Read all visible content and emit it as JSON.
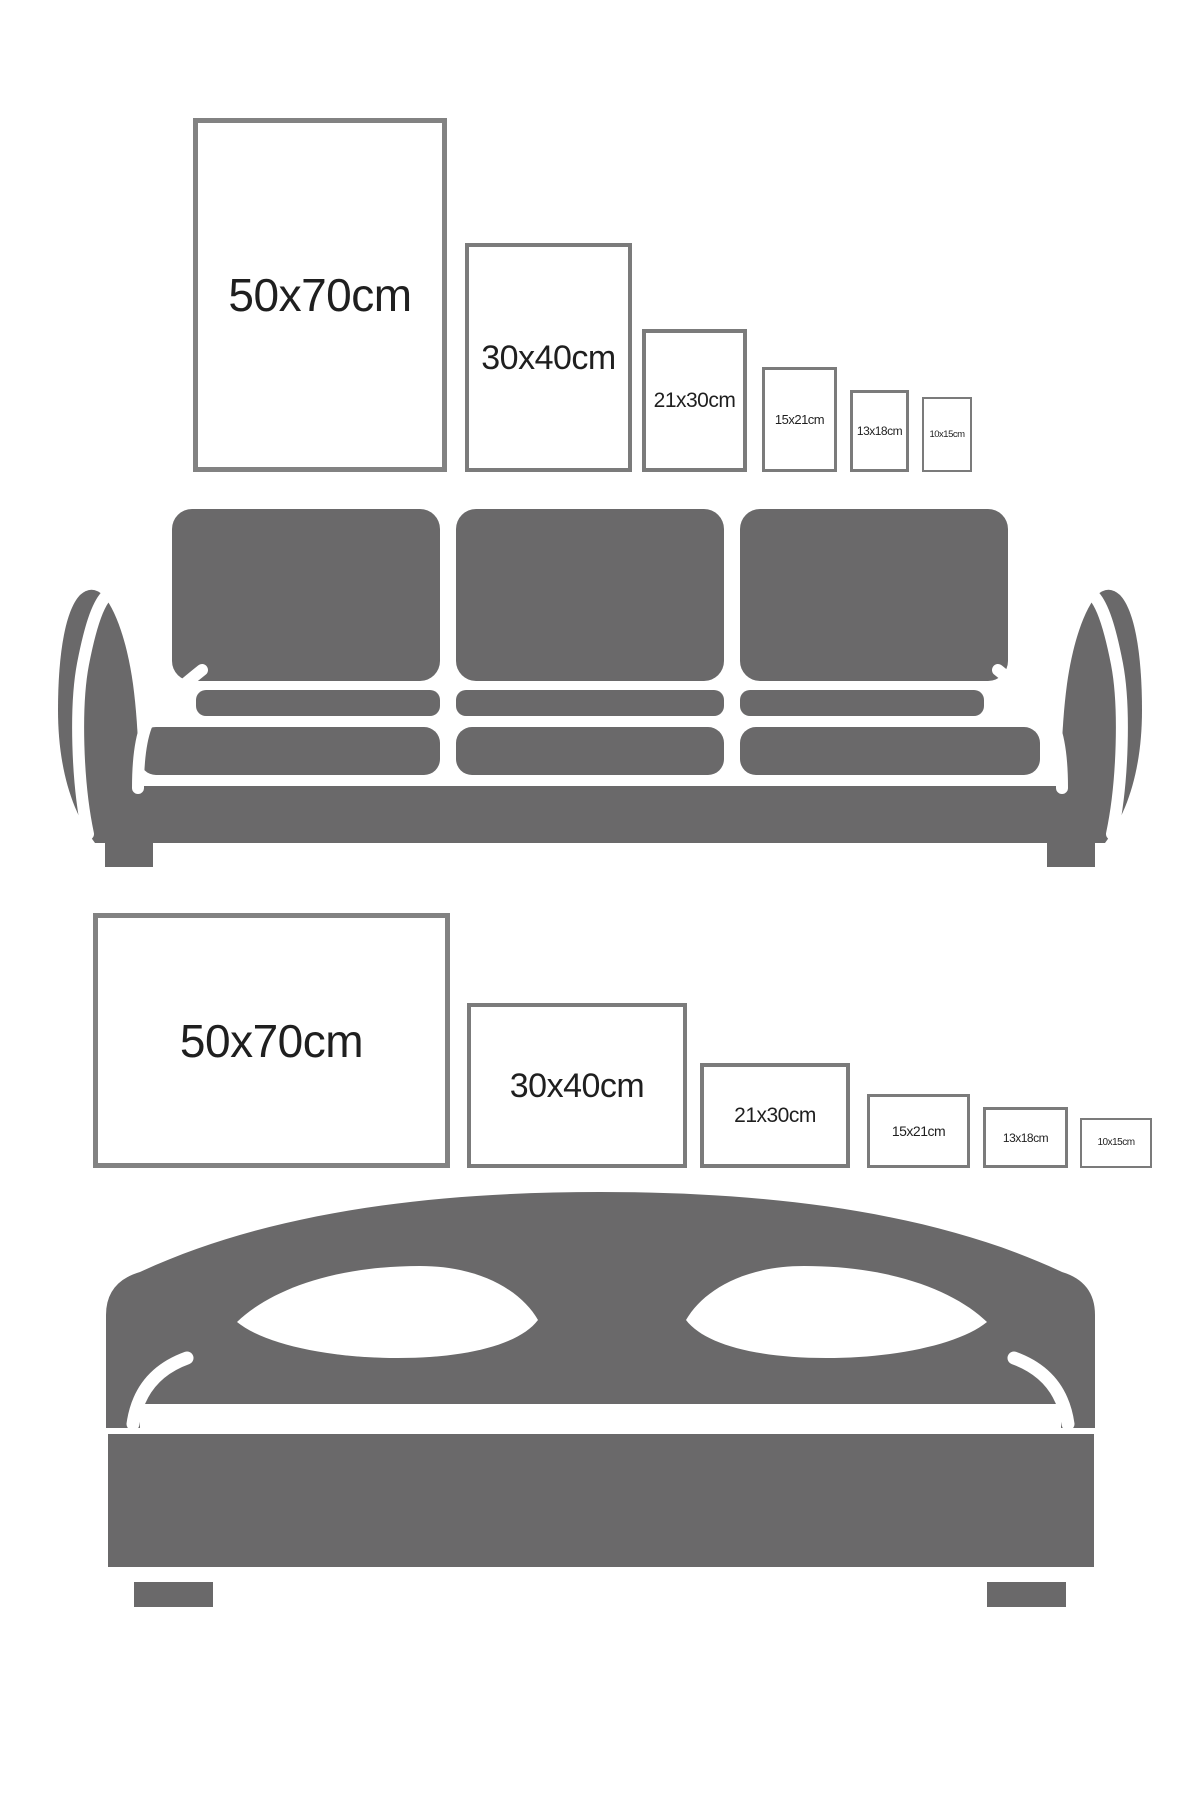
{
  "colors": {
    "background": "#ffffff",
    "furniture_gray": "#6a696a",
    "frame_border": "#7b7b7b",
    "frame_border_large": "#828282",
    "label_text": "#1f1f1f"
  },
  "top_scene": {
    "illustration": "sofa",
    "frames": [
      {
        "label": "50x70cm",
        "orientation": "portrait"
      },
      {
        "label": "30x40cm",
        "orientation": "portrait"
      },
      {
        "label": "21x30cm",
        "orientation": "portrait"
      },
      {
        "label": "15x21cm",
        "orientation": "portrait"
      },
      {
        "label": "13x18cm",
        "orientation": "portrait"
      },
      {
        "label": "10x15cm",
        "orientation": "portrait"
      }
    ]
  },
  "bottom_scene": {
    "illustration": "bed",
    "frames": [
      {
        "label": "50x70cm",
        "orientation": "landscape"
      },
      {
        "label": "30x40cm",
        "orientation": "landscape"
      },
      {
        "label": "21x30cm",
        "orientation": "landscape"
      },
      {
        "label": "15x21cm",
        "orientation": "landscape"
      },
      {
        "label": "13x18cm",
        "orientation": "landscape"
      },
      {
        "label": "10x15cm",
        "orientation": "landscape"
      }
    ]
  }
}
